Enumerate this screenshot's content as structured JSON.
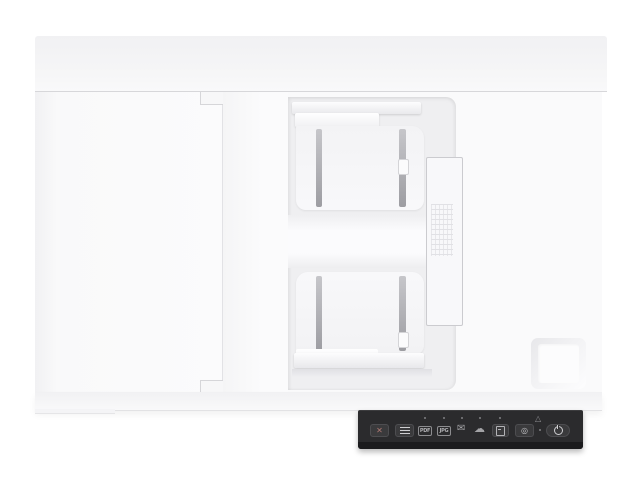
{
  "image": {
    "type": "product-photo",
    "subject": "Top view of a white flatbed document scanner with automatic document feeder and dark control panel",
    "background_color": "#ffffff",
    "body_color": "#fafafb",
    "recess_color": "#efeff1",
    "panel_color": "#2b2b2d"
  },
  "control_panel": {
    "cancel": {
      "glyph": "✕",
      "icon": "cancel-x-icon"
    },
    "feed_mode": {
      "icon": "feed-mode-lines-icon"
    },
    "dest_pdf": {
      "label": "PDF",
      "icon": "pdf-badge-icon"
    },
    "dest_jpg": {
      "label": "JPG",
      "icon": "jpg-badge-icon"
    },
    "dest_email": {
      "glyph": "✉",
      "icon": "email-envelope-icon"
    },
    "dest_cloud": {
      "glyph": "☁",
      "icon": "cloud-icon"
    },
    "shortcut": {
      "icon": "document-icon"
    },
    "scan": {
      "glyph": "◎",
      "icon": "scan-target-icon"
    },
    "error": {
      "glyph": "△",
      "icon": "error-triangle-icon"
    },
    "power": {
      "icon": "power-icon"
    }
  }
}
